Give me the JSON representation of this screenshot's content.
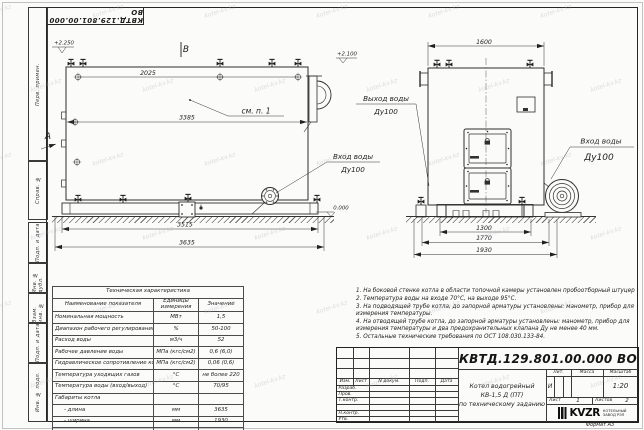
{
  "stamp": {
    "code": "КВТД.129.801.00.000 ВО"
  },
  "frame": {
    "col_top": [
      "Перв. примен.",
      "Справ. №"
    ],
    "col_bottom": [
      "Подп. и дата",
      "Инв. № дубл.",
      "Взам. инв. №",
      "Подп. и дата",
      "Инв. № подл."
    ]
  },
  "side_view": {
    "view_label": "В",
    "arrow_label": "А",
    "elev_top": "+2.250",
    "elev_right": "+2.100",
    "elev_zero": "0.000",
    "note_ref": "см. п. 1",
    "dim_top_valves": "2025",
    "dim_body": "3385",
    "dim_base": "3515",
    "dim_total": "3635"
  },
  "front_view": {
    "dim_width": "1600",
    "dim_base_inner": "1300",
    "dim_base_outer": "1770",
    "dim_total": "1930"
  },
  "labels": {
    "outlet": {
      "l1": "Выход воды",
      "l2": "Ду100"
    },
    "inlet_side": {
      "l1": "Вход воды",
      "l2": "Ду100"
    },
    "inlet_front": {
      "l1": "Вход воды",
      "l2": "Ду100"
    }
  },
  "spec_table": {
    "title": "Техническая характеристика",
    "headers": [
      "Наименование показателя",
      "Единицы измерения",
      "Значение"
    ],
    "rows": [
      [
        "Номинальная мощность",
        "МВт",
        "1,5"
      ],
      [
        "Диапазон рабочего регулирования",
        "%",
        "50-100"
      ],
      [
        "Расход воды",
        "м3/ч",
        "52"
      ],
      [
        "Рабочее давление воды",
        "МПа (кгс/см2)",
        "0,6 (6,0)"
      ],
      [
        "Гидравлическое сопротивление котла",
        "МПа (кгс/см2)",
        "0,06 (0,6)"
      ],
      [
        "Температура уходящих газов",
        "°С",
        "не более 220"
      ],
      [
        "Температура воды (вход/выход)",
        "°С",
        "70/95"
      ],
      [
        "Габариты котла",
        "",
        ""
      ],
      [
        "- длина",
        "мм",
        "3635"
      ],
      [
        "- ширина",
        "мм",
        "1930"
      ],
      [
        "- высота",
        "мм",
        "2250"
      ]
    ]
  },
  "notes": [
    "1. На боковой стенке котла в области топочной камеры установлен пробоотборный штуцер",
    "2. Температура воды на входе 70°С, на выходе 95°С.",
    "3. На подводящей трубе котла, до запорной арматуры установлены: манометр, прибор для измерения температуры.",
    "4. На отводящей трубе котла, до запорной арматуры установлены: манометр, прибор для измерения температуры и два предохранительных клапана Ду не менее 40 мм.",
    "5. Остальные технические требования по ОСТ 108.030.133-84."
  ],
  "title_block": {
    "designation": "КВТД.129.801.00.000 ВО",
    "rev_cols": [
      "Изм.",
      "Лист",
      "N докум.",
      "Подп.",
      "Дата"
    ],
    "sign_rows": [
      "Разраб.",
      "Пров.",
      "Т.контр.",
      "Н.контр.",
      "Утв."
    ],
    "product": [
      "Котел водогрейный",
      "КВ-1,5 Д (ПТ)",
      "по техническому заданию"
    ],
    "lit_label": "Лит.",
    "lit": "И",
    "mass_label": "Масса",
    "scale_label": "Масштаб",
    "scale": "1:20",
    "sheet_label": "Лист",
    "sheet": "1",
    "sheets_label": "Листов",
    "sheets": "2",
    "company": "KVZR",
    "company_line1": "КОТЕЛЬНЫЙ",
    "company_line2": "ЗАВОД РЭП",
    "format": "Формат А3"
  },
  "watermark": {
    "text": "kotel-kv.kz"
  }
}
